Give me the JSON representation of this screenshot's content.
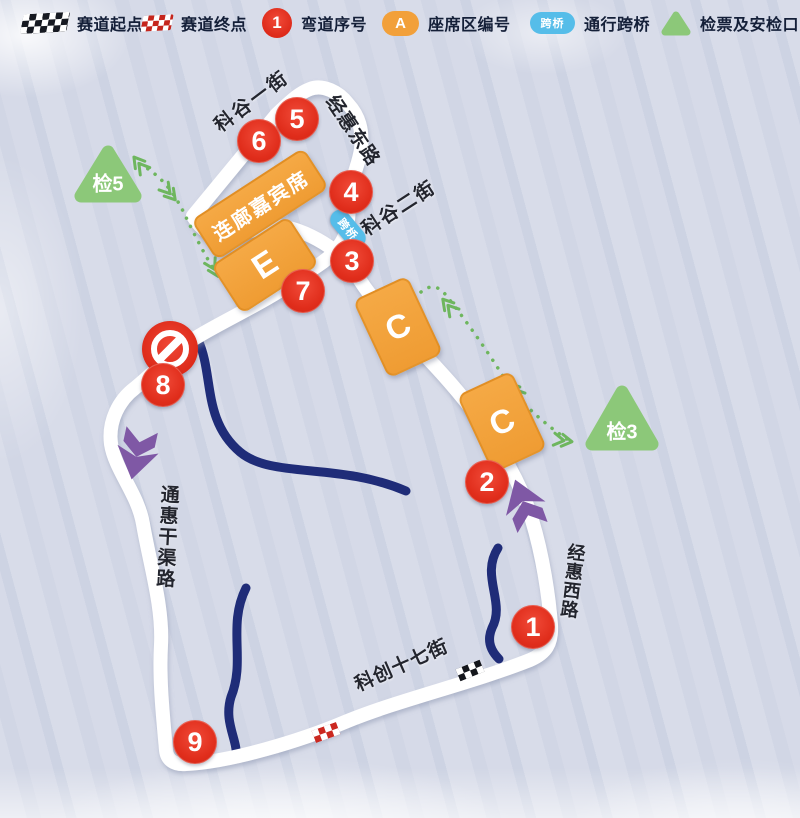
{
  "legend": {
    "items": [
      {
        "label": "赛道起点"
      },
      {
        "label": "赛道终点"
      },
      {
        "sample": "1",
        "label": "弯道序号"
      },
      {
        "sample": "A",
        "label": "座席区编号"
      },
      {
        "sample": "跨桥",
        "label": "通行跨桥"
      },
      {
        "label": "检票及安检口"
      }
    ]
  },
  "map": {
    "curves": [
      "1",
      "2",
      "3",
      "4",
      "5",
      "6",
      "7",
      "8",
      "9"
    ],
    "streets": {
      "kegu_first": "科谷一街",
      "jinghui_east": "经惠东路",
      "kegu_second": "科谷二街",
      "tonghui_canal": "通惠干渠路",
      "jinghui_west": "经惠西路",
      "kechuang_17": "科创十七街"
    },
    "areas": {
      "corridor": "连廊嘉宾席",
      "e": "E",
      "c_upper": "C",
      "c_lower": "C"
    },
    "checkpoints": {
      "cp5": "检5",
      "cp3": "检3"
    },
    "bridge_label": "跨桥"
  },
  "colors": {
    "red": "#e02d1b",
    "orange": "#f2a03a",
    "green": "#8cc879",
    "blue": "#56bde9",
    "purple": "#7f58a5",
    "river": "#1f2c78",
    "road": "#ffffff",
    "background": "#d4d9e7"
  }
}
